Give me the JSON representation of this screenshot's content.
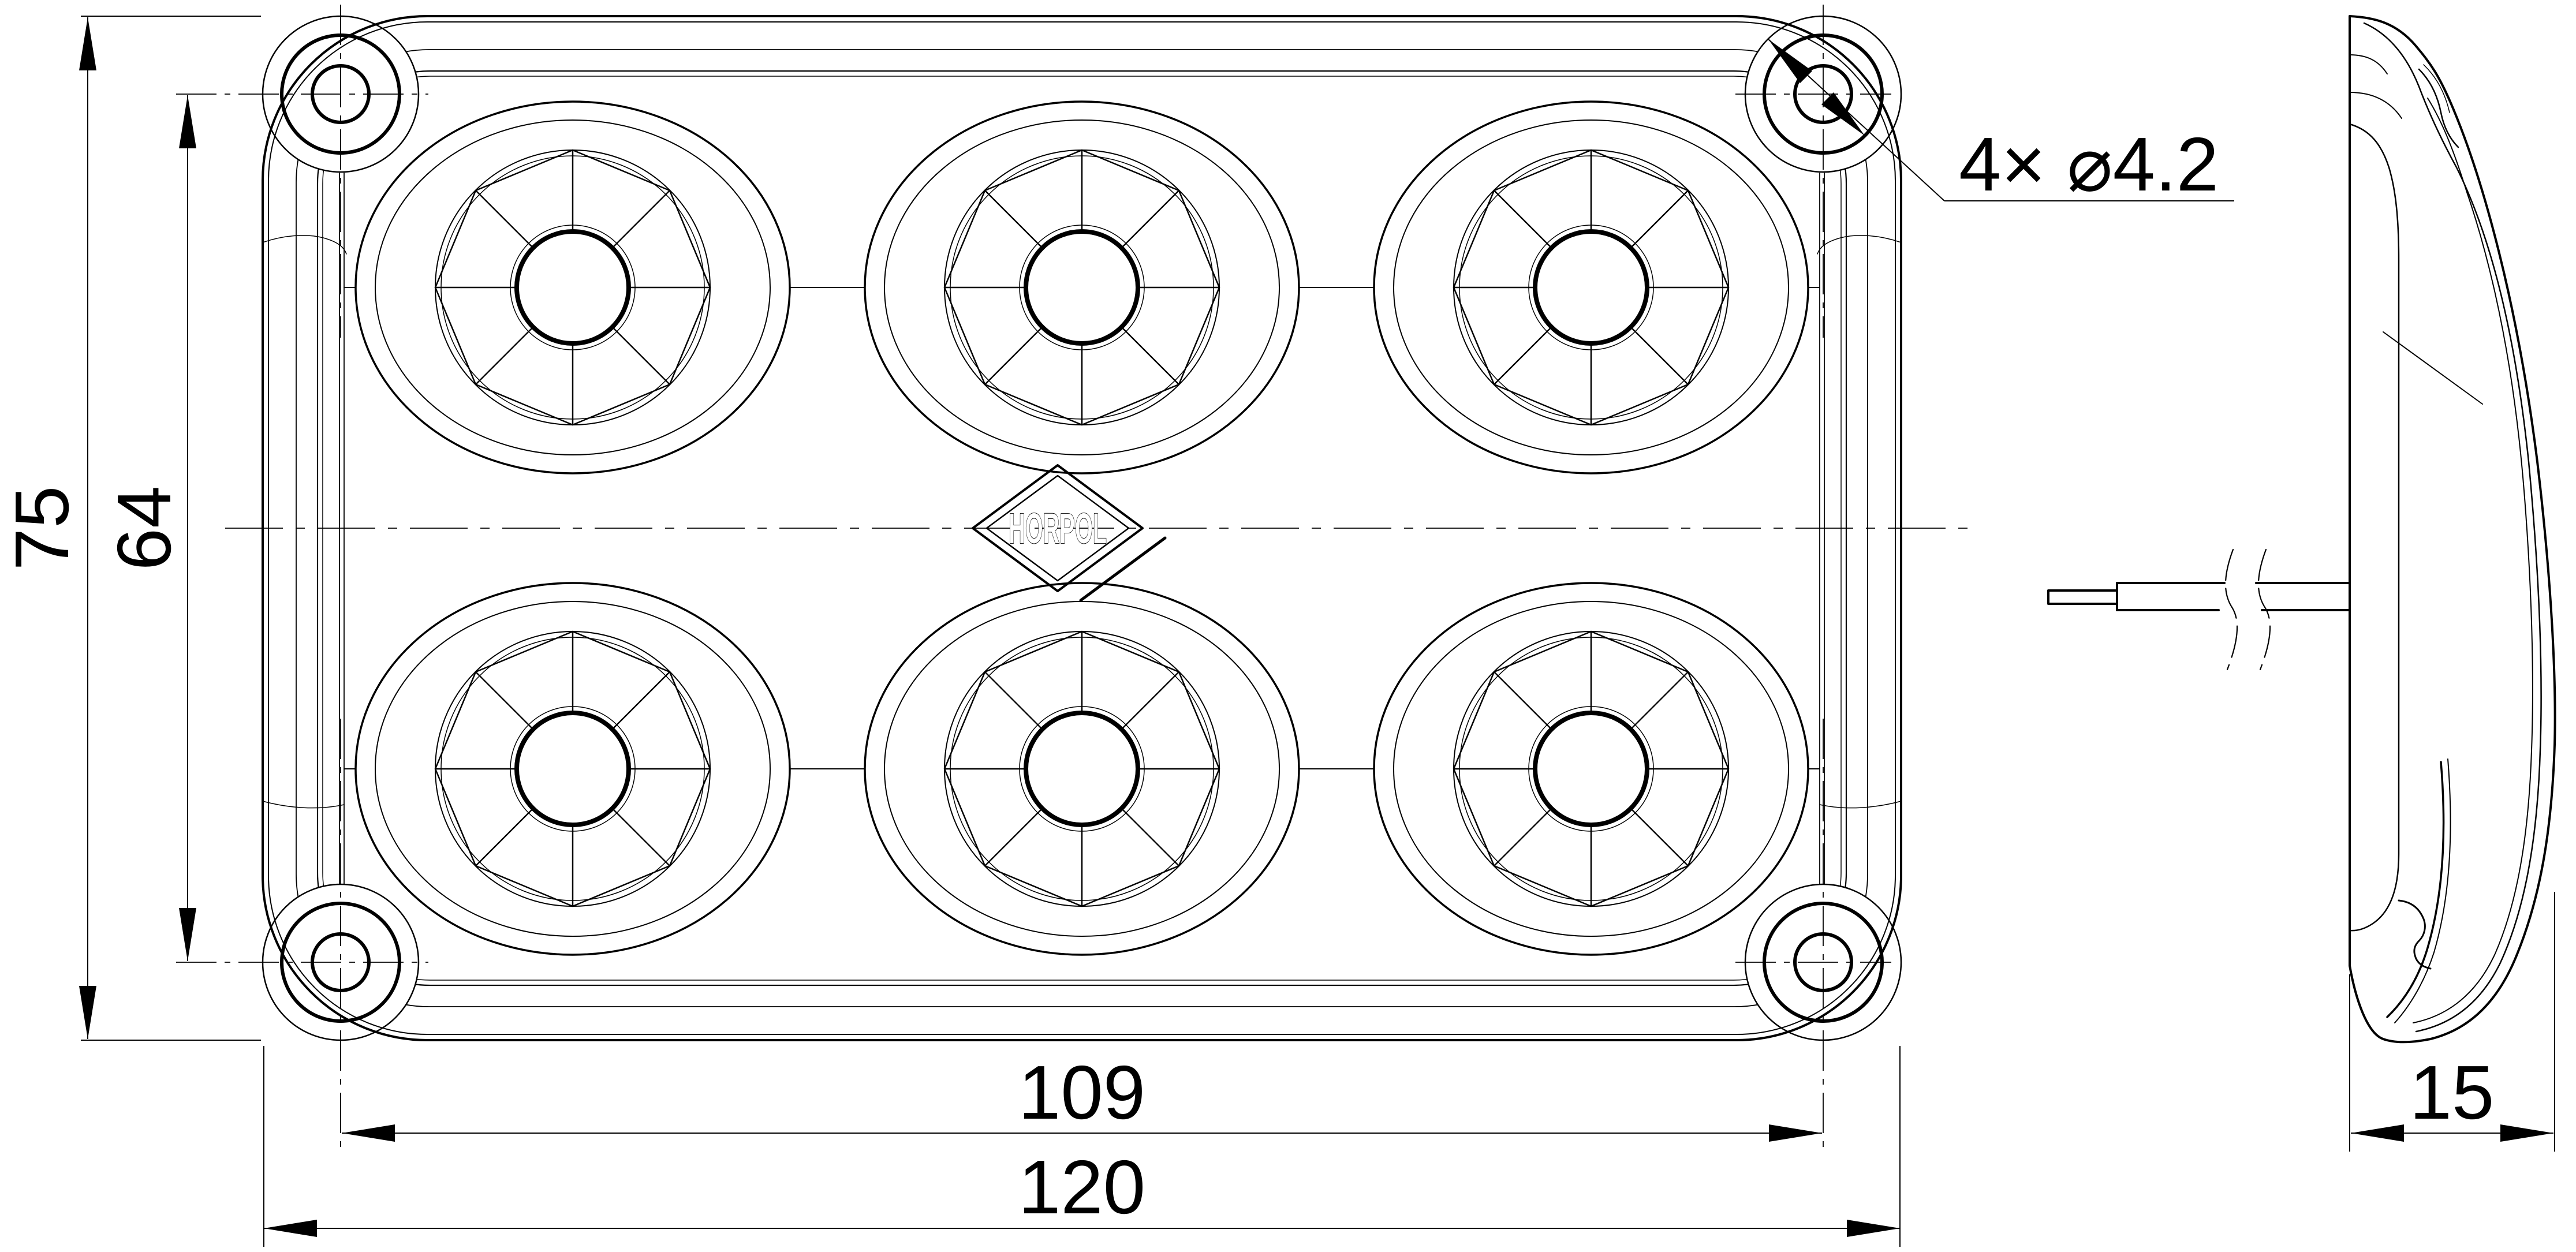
{
  "drawing": {
    "brand_logo_text": "HORPOL",
    "labels": {
      "overall_height": "75",
      "hole_pitch_vertical": "64",
      "hole_pitch_horizontal": "109",
      "overall_width": "120",
      "depth": "15",
      "hole_callout": "4× ⌀4.2"
    },
    "colors": {
      "line": "#000000",
      "background": "#ffffff"
    }
  }
}
